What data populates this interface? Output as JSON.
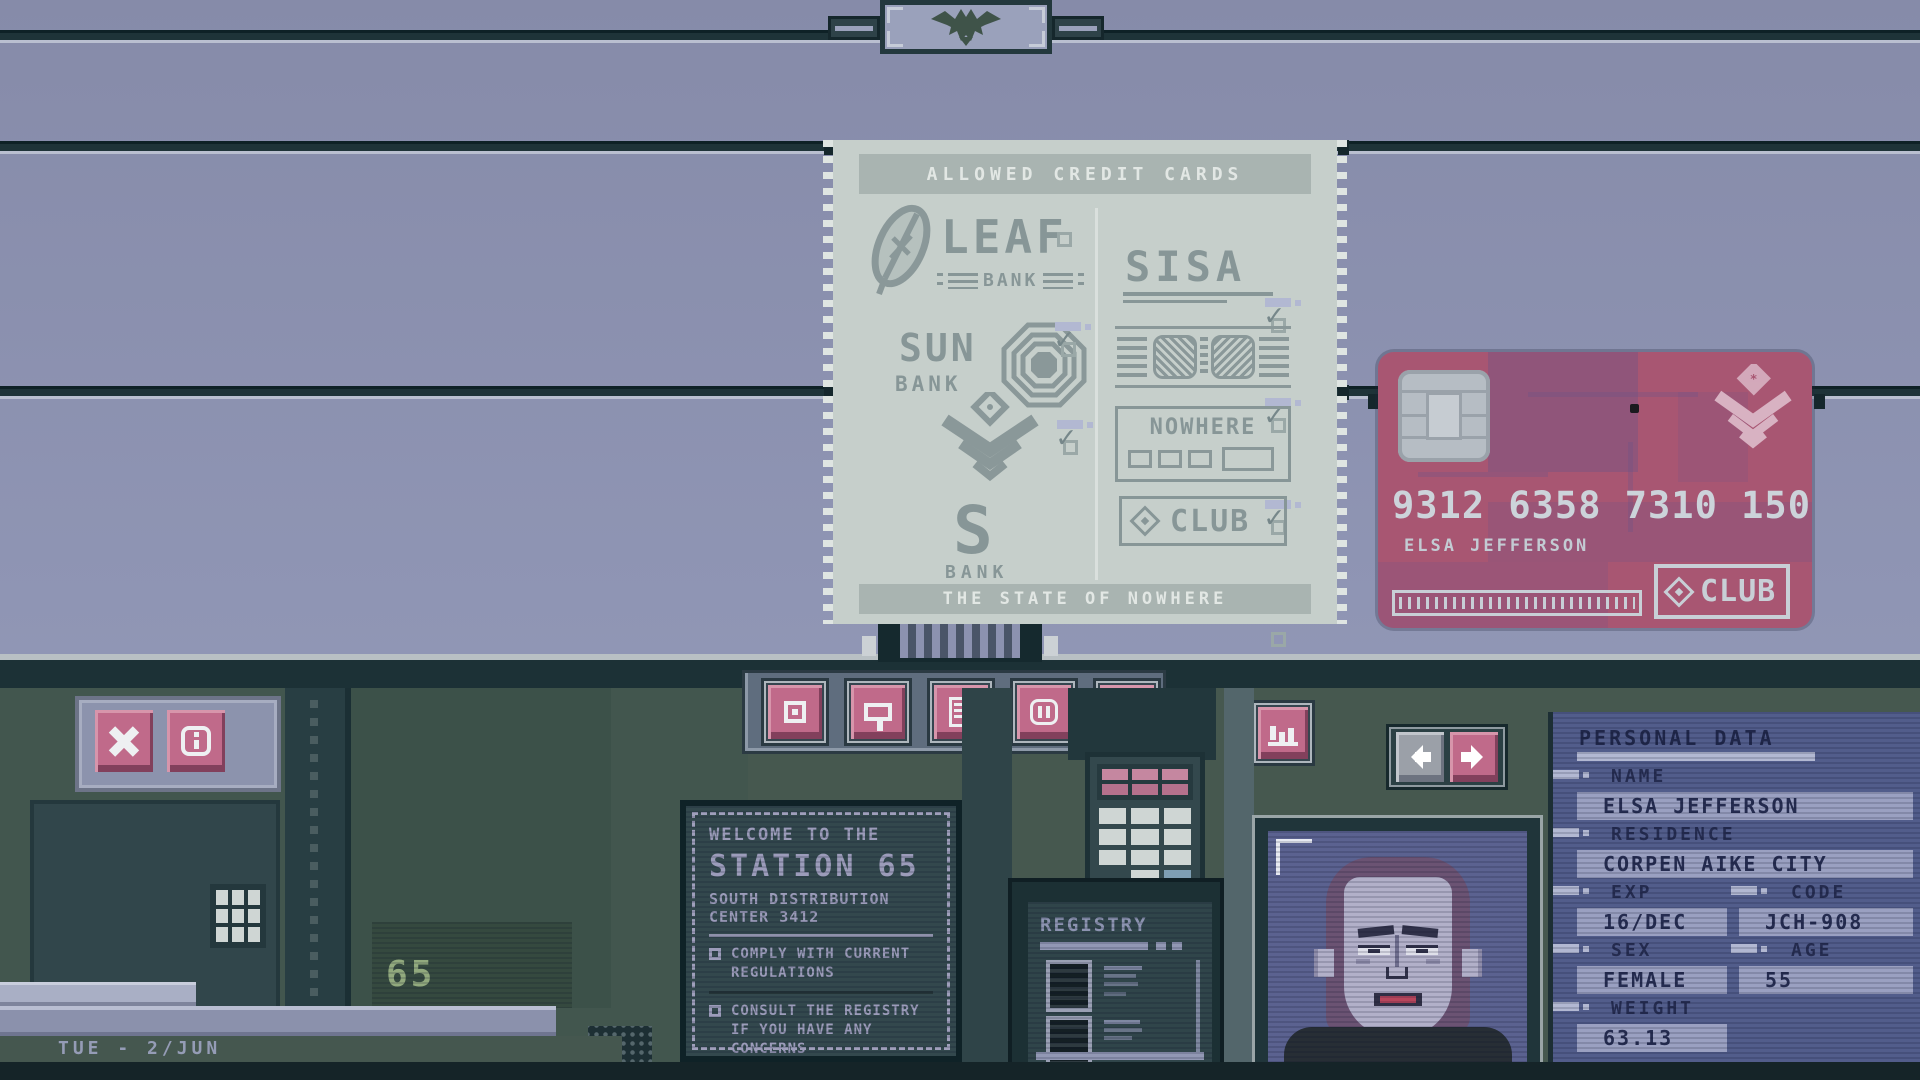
{
  "poster": {
    "title": "ALLOWED CREDIT CARDS",
    "footer": "THE STATE OF NOWHERE",
    "leaf": {
      "name": "LEAF",
      "sub": "BANK"
    },
    "sun": {
      "name": "SUN",
      "sub": "BANK"
    },
    "sbank": {
      "name": "S",
      "sub": "BANK"
    },
    "sisa": {
      "name": "SISA"
    },
    "nowhere": {
      "name": "NOWHERE"
    },
    "club": {
      "name": "CLUB"
    }
  },
  "credit_card": {
    "number": "9312 6358 7310 1507",
    "holder": "ELSA JEFFERSON",
    "brand": "CLUB"
  },
  "sign": {
    "welcome": "WELCOME TO THE",
    "station": "STATION 65",
    "sub1": "SOUTH DISTRIBUTION",
    "sub2": "CENTER 3412",
    "rule1_l1": "COMPLY WITH CURRENT",
    "rule1_l2": "REGULATIONS",
    "rule2_l1": "CONSULT THE REGISTRY",
    "rule2_l2": "IF YOU HAVE ANY",
    "rule2_l3": "CONCERNS"
  },
  "registry": {
    "title": "REGISTRY"
  },
  "machinery": {
    "unit_label": "65"
  },
  "statusbar": {
    "date": "TUE - 2/JUN"
  },
  "personal_data": {
    "title": "PERSONAL DATA",
    "name_label": "NAME",
    "name": "ELSA JEFFERSON",
    "residence_label": "RESIDENCE",
    "residence": "CORPEN AIKE CITY",
    "exp_label": "EXP",
    "exp": "16/DEC",
    "code_label": "CODE",
    "code": "JCH-908",
    "sex_label": "SEX",
    "sex": "FEMALE",
    "age_label": "AGE",
    "age": "55",
    "weight_label": "WEIGHT",
    "weight": "63.13"
  },
  "colors": {
    "wall": "#8a90b0",
    "paper": "#c6cfcb",
    "card_pink": "#a85672",
    "accent_pink": "#c06a8a",
    "panel_blue": "#525d8b",
    "desk_teal": "#33484d"
  }
}
